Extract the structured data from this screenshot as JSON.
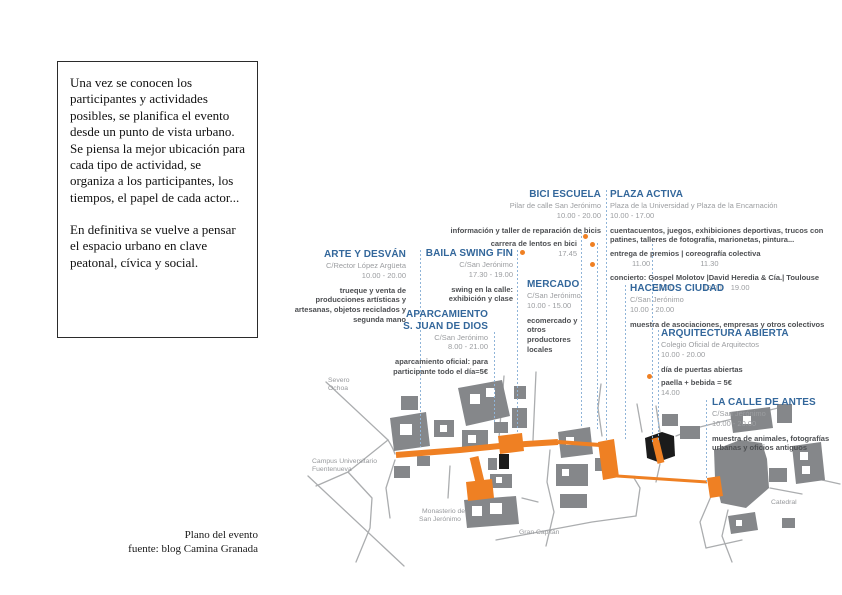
{
  "intro": {
    "p1": "Una vez se conocen los participantes y actividades posibles, se planifica el evento desde un punto de vista urbano.",
    "p2": "Se piensa la mejor ubicación para cada tipo de actividad, se organiza a los participantes, los tiempos, el papel de cada actor...",
    "p3": "En definitiva se vuelve a pensar el espacio urbano en clave peatonal, cívica y social."
  },
  "caption": {
    "title": "Plano del evento",
    "source": "fuente: blog Camina Granada"
  },
  "events": [
    {
      "id": "arte-y-desvan",
      "title": "ARTE Y DESVÁN",
      "location": "C/Rector López Argüeta",
      "hours": "10.00 - 20.00",
      "description": "trueque y venta de producciones artísticas y artesanas, objetos reciclados y segunda mano"
    },
    {
      "id": "baila-swing-fin",
      "title": "BAILA SWING FIN",
      "location": "C/San Jerónimo",
      "hours": "17.30 - 19.00",
      "description": "swing en la calle: exhibición y clase"
    },
    {
      "id": "aparcamiento-s-juan-de-dios",
      "title": "APARCAMIENTO",
      "title2": "S. JUAN DE DIOS",
      "location": "C/San Jerónimo",
      "hours": "8.00 - 21.00",
      "description": "aparcamiento oficial: para participante todo el día=5€"
    },
    {
      "id": "bici-escuela",
      "title": "BICI ESCUELA",
      "location": "Pilar de calle San Jerónimo",
      "hours": "10.00 - 20.00",
      "description": "información y taller de reparación de bicis",
      "schedule": [
        {
          "label": "carrera de lentos en bici",
          "time": "17.45"
        }
      ]
    },
    {
      "id": "mercado",
      "title": "MERCADO",
      "location": "C/San Jerónimo",
      "hours": "10.00 - 15.00",
      "description": "ecomercado y otros productores locales"
    },
    {
      "id": "plaza-activa",
      "title": "PLAZA ACTIVA",
      "location": "Plaza de la Universidad y Plaza de la Encarnación",
      "hours": "10.00 - 17.00",
      "description": "cuentacuentos, juegos, exhibiciones deportivas, trucos con patines, talleres de fotografía, marionetas, pintura...",
      "schedule": [
        {
          "label": "entrega de premios  |  coreografía colectiva",
          "times": [
            "11.00",
            "11.30"
          ]
        },
        {
          "label": "concierto: Gospel Molotov |David Heredia & Cía.| Toulouse",
          "times": [
            "17.00",
            "18.00",
            "19.00"
          ]
        }
      ]
    },
    {
      "id": "hacemos-ciudad",
      "title": "HACEMOS CIUDAD",
      "location": "C/San Jerónimo",
      "hours": "10.00 - 20.00",
      "description": "muestra de asociaciones, empresas y otros colectivos"
    },
    {
      "id": "arquitectura-abierta",
      "title": "ARQUITECTURA ABIERTA",
      "location": "Colegio Oficial de Arquitectos",
      "hours": "10.00 - 20.00",
      "description": "día de puertas abiertas",
      "schedule": [
        {
          "label": "paella + bebida = 5€",
          "time": "14.00"
        }
      ]
    },
    {
      "id": "la-calle-de-antes",
      "title": "LA CALLE DE ANTES",
      "location": "C/San Jerónimo",
      "hours": "10.00 - 20.00",
      "description": "muestra de animales, fotografías urbanas y oficios antiguos"
    }
  ],
  "map": {
    "labels": {
      "severo1": "Severo",
      "severo2": "Ochoa",
      "campus1": "Campus Universitario",
      "campus2": "Fuentenueva",
      "monasterio1": "Monasterio de",
      "monasterio2": "San Jerónimo",
      "gran_capitan": "Gran Capitán",
      "catedral": "Catedral"
    }
  },
  "colors": {
    "header_blue": "#33679b",
    "event_orange": "#ef8023",
    "building_gray": "#85878a",
    "street_gray": "#abadaf",
    "muted_gray": "#9b9da0",
    "dark_text": "#4d4f52",
    "guide_blue": "#8fb4d8"
  }
}
